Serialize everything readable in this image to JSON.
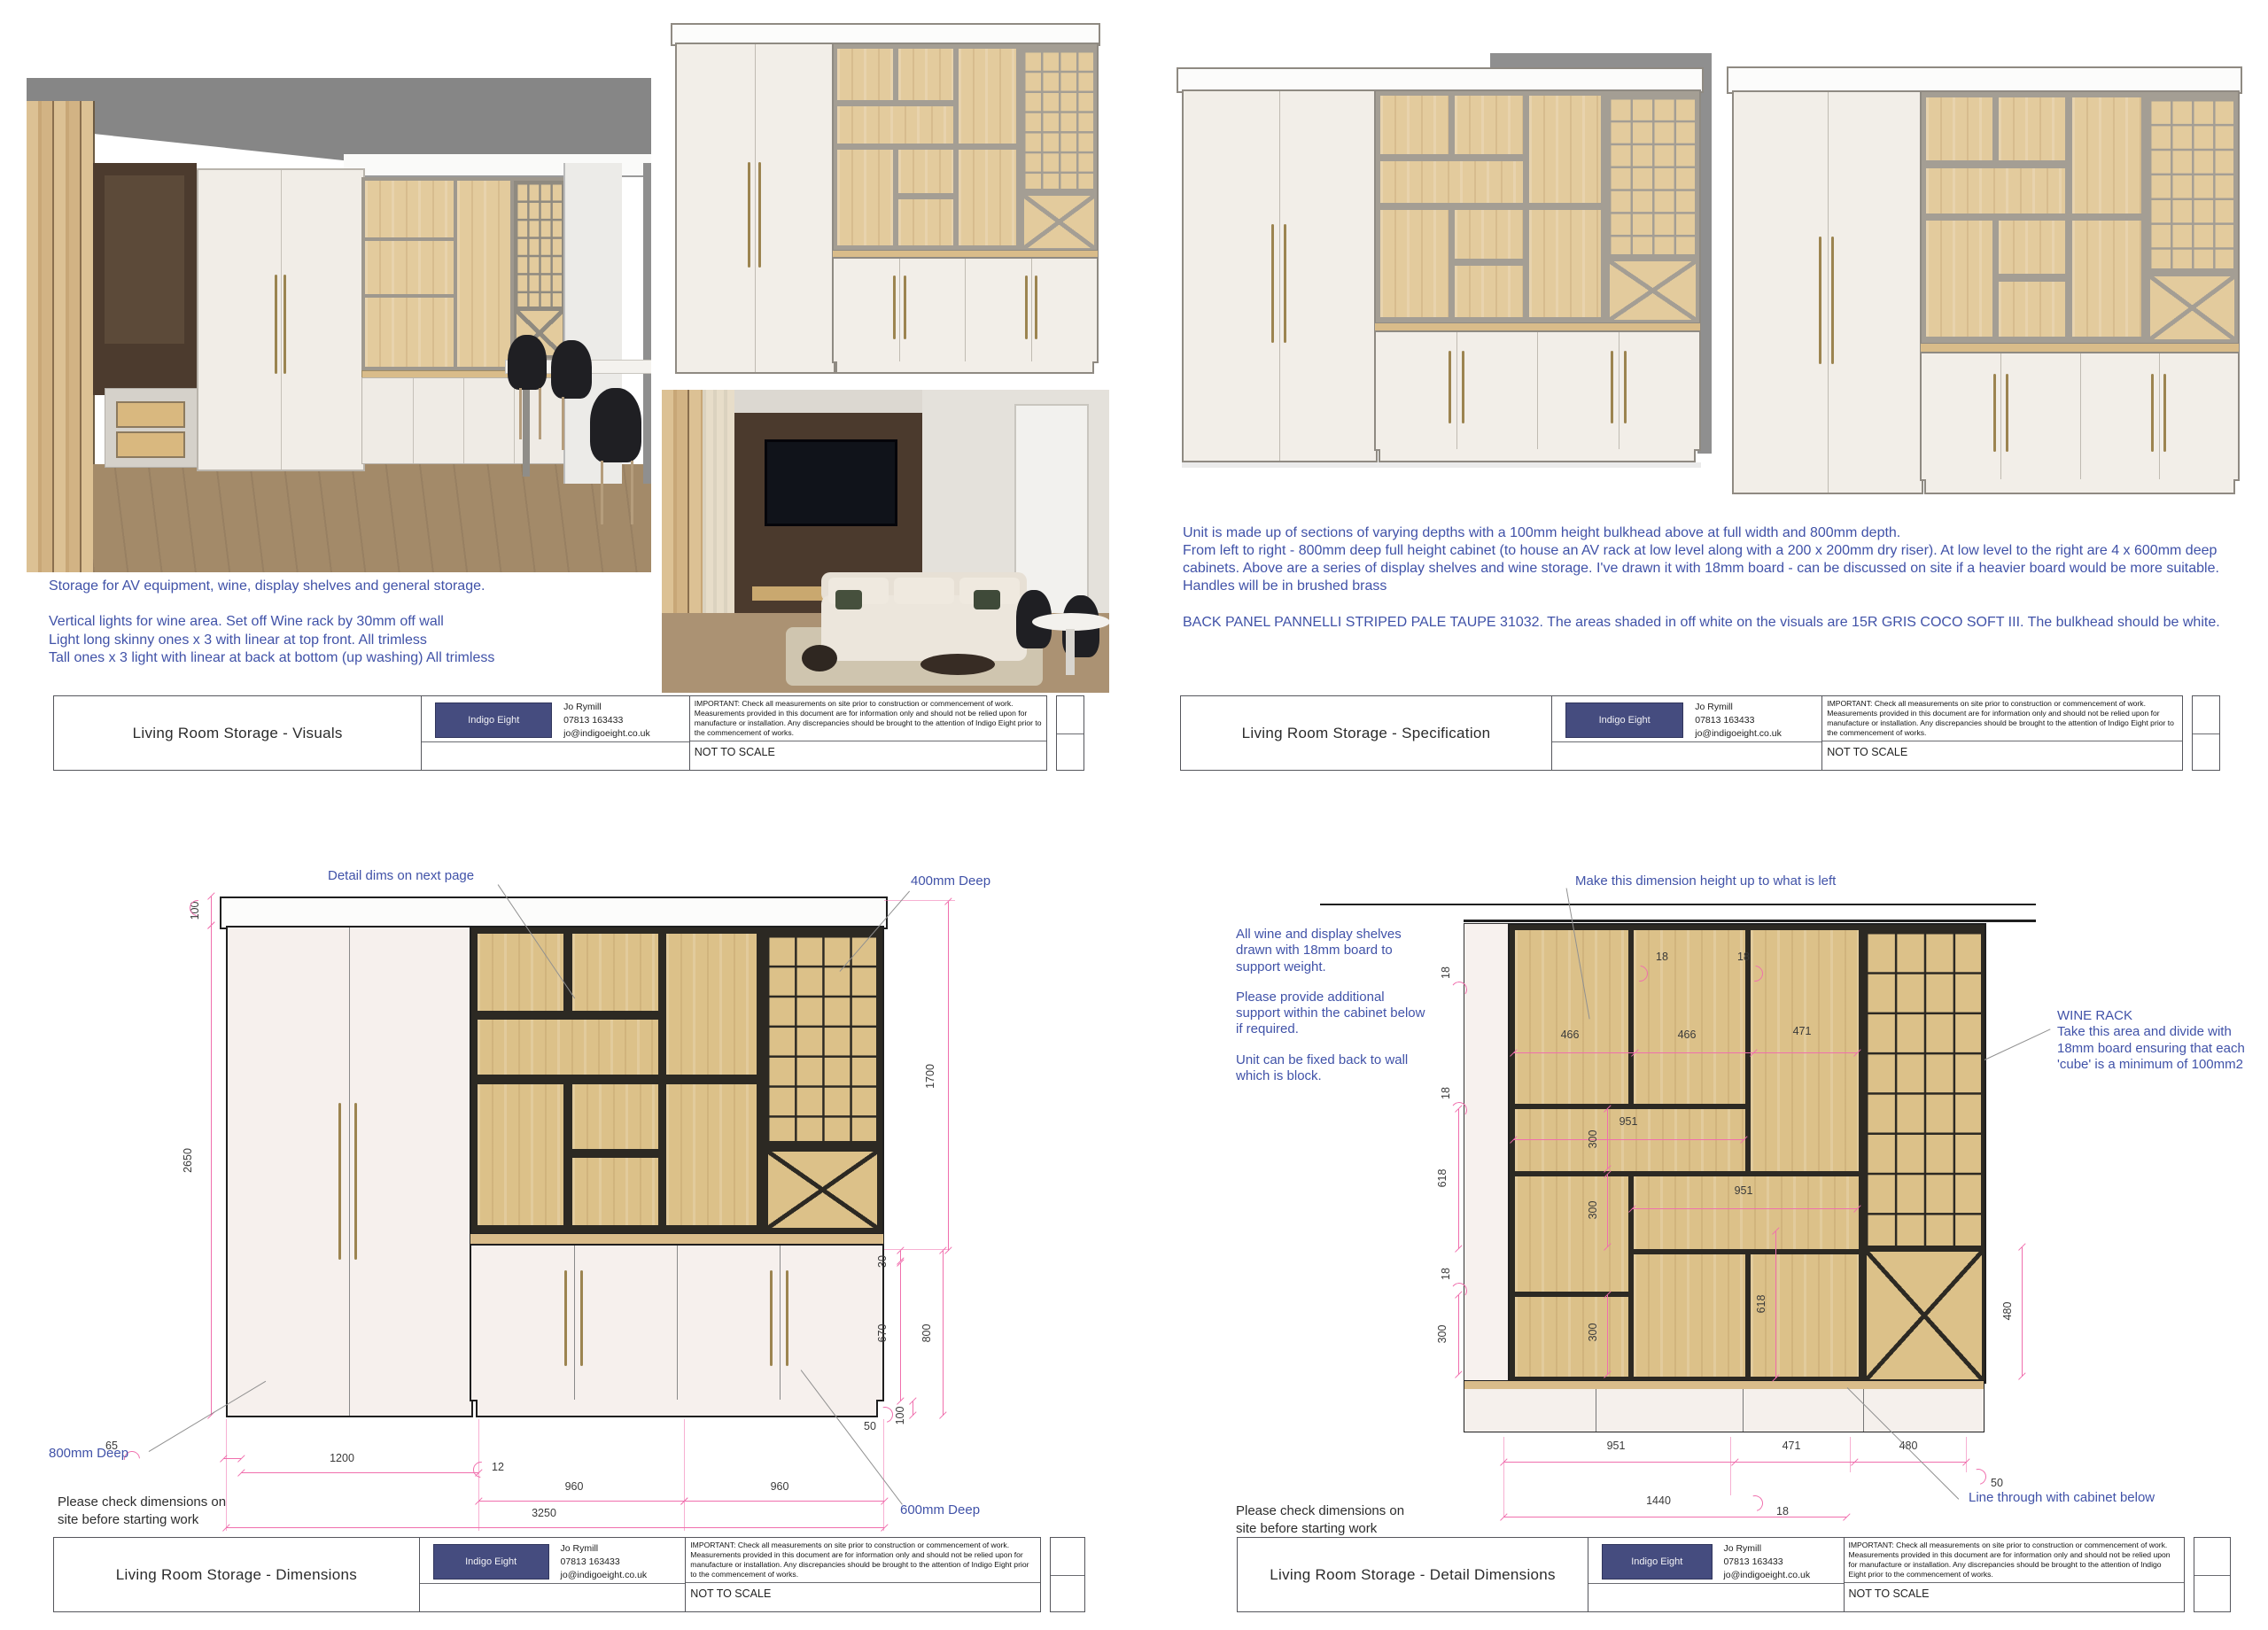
{
  "colors": {
    "accent_blue": "#4052a8",
    "dim_pink": "#f06fad",
    "logo_navy": "#454c7f",
    "wood": "#dcc189",
    "frame_dark": "#2c2923",
    "cabinet_offwhite": "#f6f0ed"
  },
  "title_block": {
    "brand": "Indigo Eight",
    "contact_name": "Jo Rymill",
    "contact_phone": "07813 163433",
    "contact_email": "jo@indigoeight.co.uk",
    "important": "IMPORTANT: Check all measurements on site prior to construction or commencement of work. Measurements provided in this document are for information only and should not be relied upon for manufacture or installation. Any discrepancies should be brought to the attention of Indigo Eight prior to the commencement of works.",
    "scale_note": "NOT TO SCALE"
  },
  "sheets": {
    "visuals": {
      "title": "Living Room Storage - Visuals",
      "notes": [
        "Storage for AV equipment, wine, display shelves and general storage.",
        "Vertical lights for wine area. Set off Wine rack by 30mm off wall",
        "Light long skinny ones x 3 with linear at top front. All trimless",
        "Tall ones x 3 light with linear at back at bottom (up washing) All trimless"
      ]
    },
    "specification": {
      "title": "Living Room Storage - Specification",
      "paragraphs": [
        "Unit is made up of sections of varying depths with a 100mm height bulkhead above at full width and 800mm depth.",
        "From left to right - 800mm deep full height cabinet (to house an AV rack at low level along with a 200 x 200mm dry riser). At low level to the right are 4 x 600mm deep cabinets. Above are a series of display shelves and wine storage. I've drawn it with 18mm board - can be discussed on site if a heavier board would be more suitable.",
        "Handles will be in brushed brass",
        "BACK PANEL PANNELLI STRIPED PALE TAUPE 31032. The areas shaded in off white on the visuals are 15R GRIS COCO SOFT III. The bulkhead should be white."
      ]
    },
    "dimensions": {
      "title": "Living Room Storage - Dimensions",
      "labels": {
        "detail_dims": "Detail dims on next page",
        "deep_400": "400mm Deep",
        "deep_800": "800mm Deep",
        "deep_600": "600mm Deep",
        "check_note": "Please check dimensions on site before starting work"
      },
      "dims": {
        "bulkhead": "100",
        "height": "2650",
        "shelf_height": "1700",
        "counter": "30",
        "door_h": "670",
        "base_h": "800",
        "plinth": "100",
        "recess": "50",
        "left_gap": "65",
        "cab_w": "1200",
        "gap": "12",
        "door_w1": "960",
        "door_w2": "960",
        "total_w": "3250"
      }
    },
    "detail": {
      "title": "Living Room Storage - Detail Dimensions",
      "labels": {
        "make_dim": "Make this dimension height up to what is left",
        "note1": "All wine and display shelves drawn with 18mm board to support weight.",
        "note2": "Please provide additional support within the cabinet below if required.",
        "note3": "Unit can be fixed back to wall which is block.",
        "wine_rack_title": "WINE RACK",
        "wine_rack_note": "Take this area and divide with 18mm board ensuring that each 'cube' is a minimum of 100mm2",
        "line_through": "Line through with cabinet below",
        "check_note": "Please check dimensions on site before starting work"
      },
      "dims": {
        "t18a": "18",
        "t18b": "18",
        "w466a": "466",
        "w466b": "466",
        "w471": "471",
        "w951u": "951",
        "h300u": "300",
        "w951l": "951",
        "h300m": "300",
        "h300b": "300",
        "h618l": "618",
        "h618m": "618",
        "h480r": "480",
        "l18a": "18",
        "l18b": "18",
        "l18c": "18",
        "l300": "300",
        "b951": "951",
        "b471": "471",
        "b480": "480",
        "b50": "50",
        "b18": "18",
        "b1440": "1440"
      }
    }
  }
}
